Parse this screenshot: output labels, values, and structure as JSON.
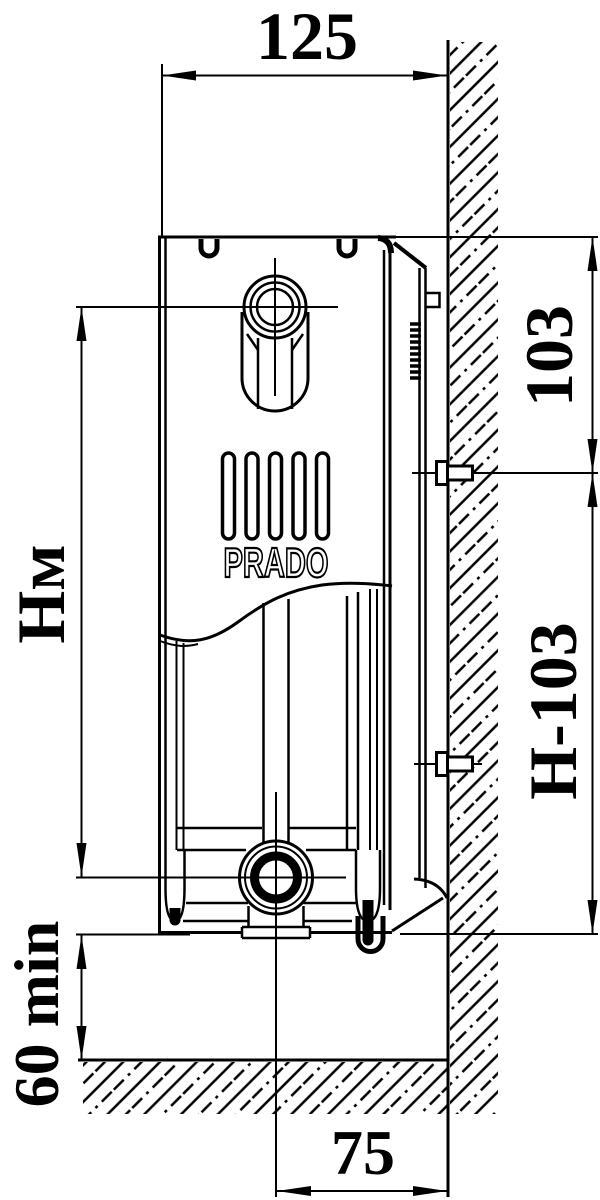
{
  "drawing": {
    "type": "radiator wall-mounting installation side view",
    "brand": "PRADO",
    "labels": {
      "depth": "125",
      "top_bracket_offset": "103",
      "bottom_bracket_offset": "Н-103",
      "mounting_height": "Нм",
      "floor_clearance_min": "60 min",
      "wall_to_pipe_axis": "75"
    },
    "colors": {
      "ink": "#000000",
      "paper": "#ffffff"
    }
  }
}
